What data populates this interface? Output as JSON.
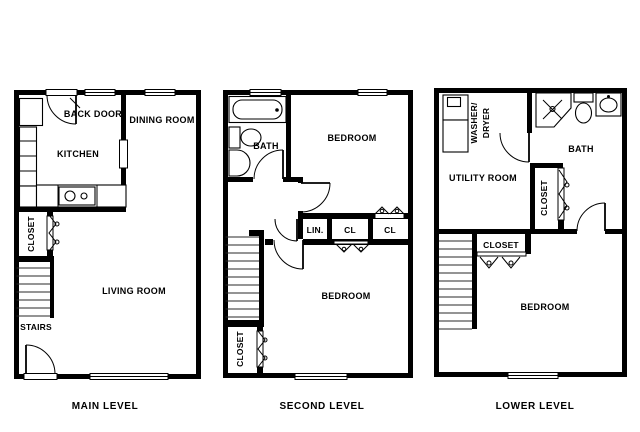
{
  "colors": {
    "background": "#ffffff",
    "line": "#000000"
  },
  "levels": {
    "main": {
      "title": "MAIN LEVEL",
      "labels": {
        "back_door": "BACK DOOR",
        "dining_room": "DINING ROOM",
        "kitchen": "KITCHEN",
        "closet": "CLOSET",
        "living_room": "LIVING ROOM",
        "stairs": "STAIRS"
      }
    },
    "second": {
      "title": "SECOND LEVEL",
      "labels": {
        "bath": "BATH",
        "bedroom_upper": "BEDROOM",
        "linen": "LIN.",
        "closet_a": "CL",
        "closet_b": "CL",
        "bedroom_lower": "BEDROOM",
        "closet": "CLOSET"
      }
    },
    "lower": {
      "title": "LOWER LEVEL",
      "labels": {
        "washer_line1": "WASHER/",
        "washer_line2": "DRYER",
        "utility_room": "UTILITY ROOM",
        "bath": "BATH",
        "closet_side": "CLOSET",
        "closet_top": "CLOSET",
        "bedroom": "BEDROOM"
      }
    }
  }
}
